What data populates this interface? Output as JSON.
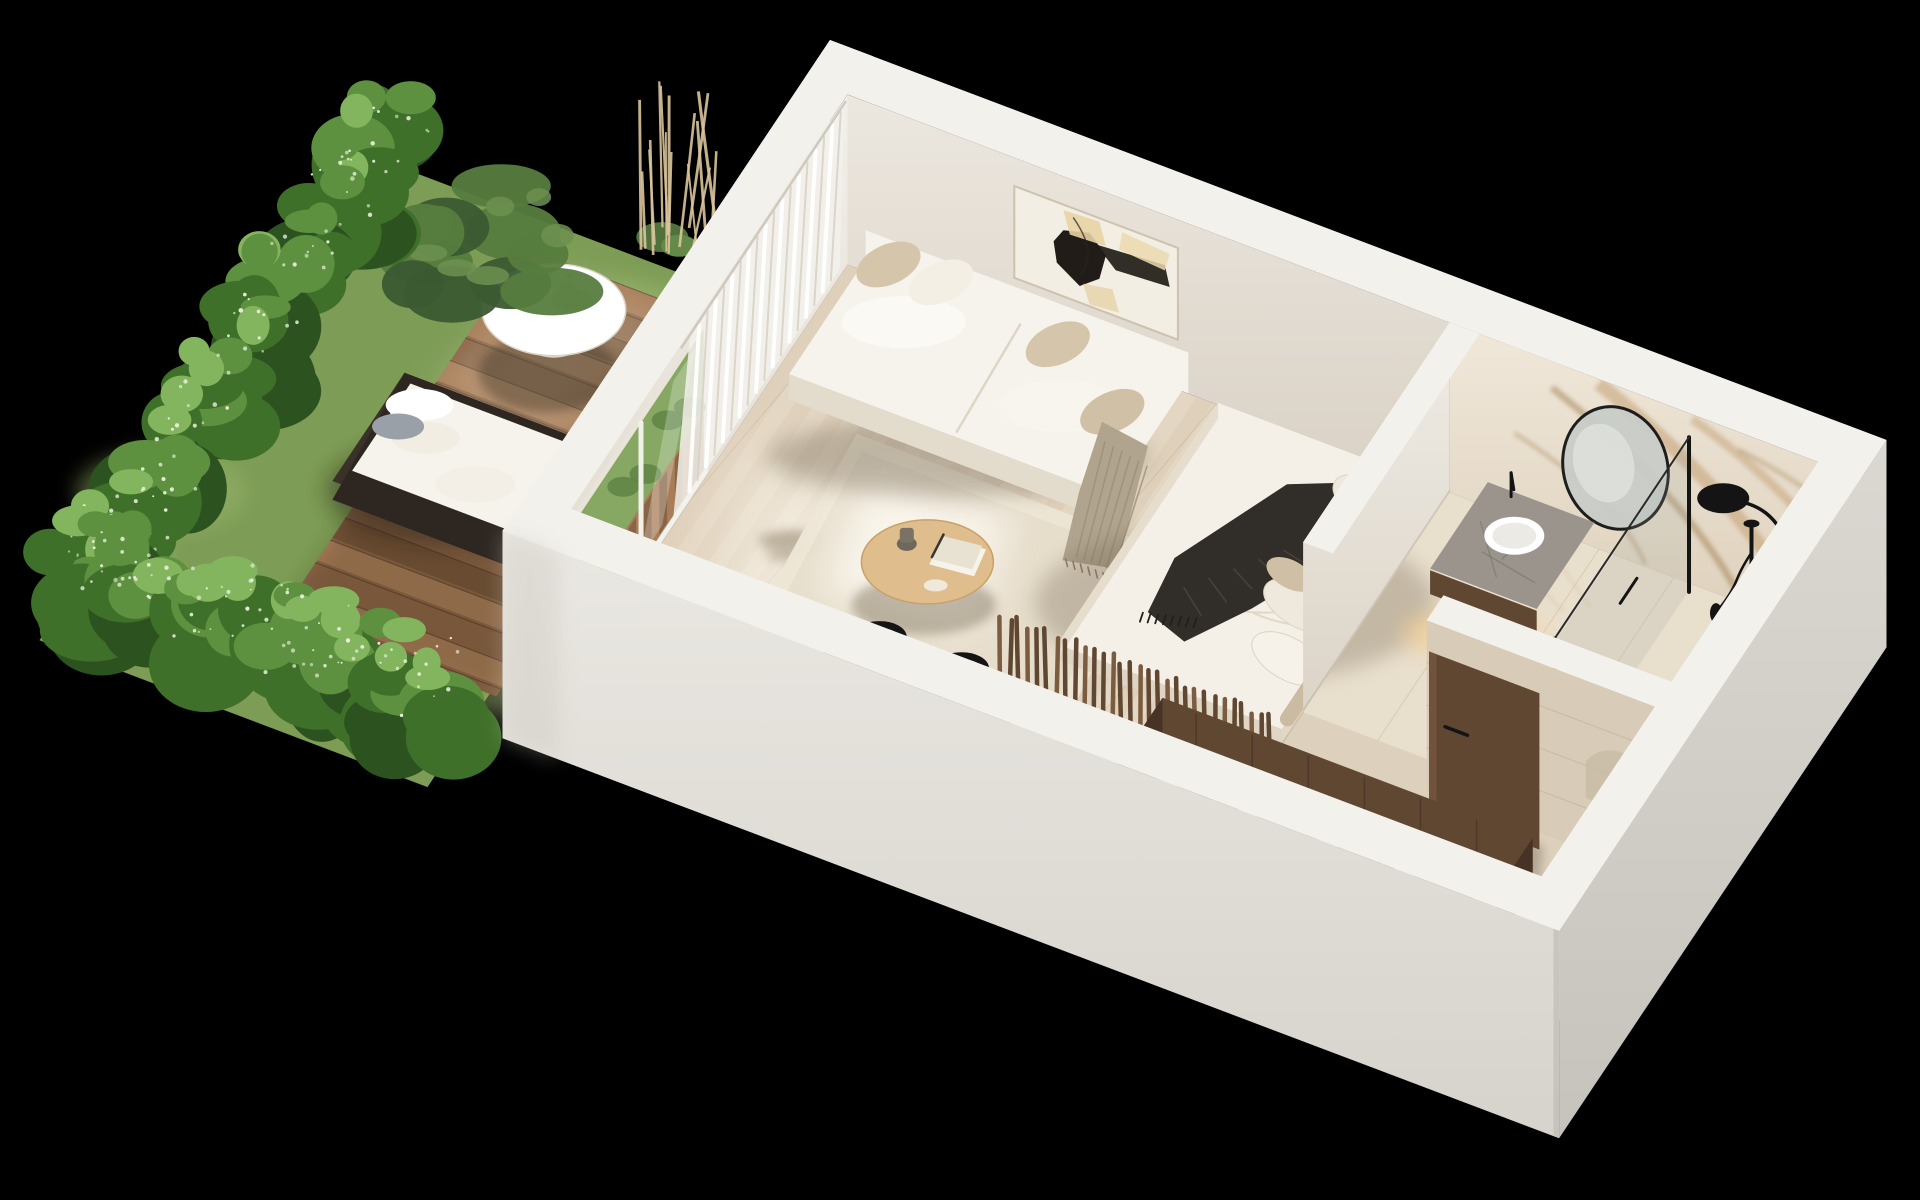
{
  "title": "Studio apartment with private garden terrace — 3D axonometric floor plan render",
  "palette": {
    "bg": "#000000",
    "wall_top": "#f3f1ec",
    "wall_top_shade": "#e9e6df",
    "wall_face": "#ece7df",
    "wall_face_low": "#d9d1c5",
    "wall_face_end": "#f1efe9",
    "facade_front": "#eae8e2",
    "facade_front_low": "#d6d3cc",
    "facade_side": "#dbd8d2",
    "facade_side_low": "#c6c3bc",
    "oak_floor": "#e3d6c2",
    "oak_floor_stripe": "#d3c2a8",
    "oak_floor_light": "#efe5d3",
    "marble_floor": "#e9dfcd",
    "marble_floor_vein": "#cdb795",
    "entry_floor": "#ddd1bd",
    "deck_a": "#8a6546",
    "deck_b": "#a87e59",
    "deck_c": "#75553a",
    "deck_gap": "#4a3422",
    "lawn": "#7d9c55",
    "lawn_light": "#99b56c",
    "hedge_dark": "#2c5220",
    "hedge_mid": "#3f7029",
    "hedge_light": "#5d9140",
    "hedge_tip": "#83b45e",
    "speckle": "#eef5e2",
    "pine_dark": "#3b5a31",
    "pine_light": "#567c3e",
    "pampas": "#d9c49a",
    "rug": "#ede5d5",
    "rug_shade": "#ddd2bd",
    "sofa": "#f6f3ec",
    "sofa_shade": "#e3dccd",
    "cushion_beige": "#d5c6ab",
    "throw_taupe": "#b1a48e",
    "oak_table": "#e0bd8d",
    "oak_table_shade": "#c9a06a",
    "walnut": "#5f4732",
    "walnut_dark": "#463326",
    "walnut_light": "#7b5c40",
    "counter": "#767069",
    "counter_dark": "#55504b",
    "black": "#141414",
    "steel": "#c2c0bb",
    "bed_white": "#f4f0e7",
    "bed_shade": "#ded5c4",
    "throw_dark": "#312d28",
    "throw_dark_hi": "#4c463d",
    "pillow_beige": "#cfc0a5",
    "headboard": "#cbbba2",
    "marble_wall": "#ece2d1",
    "marble_vein": "#c09a6b",
    "marble_vein2": "#a07f50",
    "mirror_glass": "#c9cdc8",
    "glass_green": "#86a862",
    "art_canvas": "#f2eee4",
    "art_black": "#211c17",
    "art_beige": "#e8d3a4",
    "door_beige": "#e7e1d4",
    "travertine": "#d8ccb8",
    "warm_light": "#f4cf92",
    "white": "#ffffff"
  },
  "scene": {
    "rooms": [
      {
        "name": "garden-terrace"
      },
      {
        "name": "living-kitchen"
      },
      {
        "name": "sleeping-area"
      },
      {
        "name": "bathroom"
      },
      {
        "name": "entry-wardrobe"
      }
    ],
    "objects": [
      "hedge",
      "lawn",
      "wooden-deck",
      "outdoor-daybed",
      "outdoor-coffee-table",
      "tea-set",
      "pine-shrub",
      "pampas-grass",
      "sheer-curtains",
      "sliding-glass-door",
      "abstract-wall-art",
      "sofa",
      "throw-pillows",
      "taupe-plaid",
      "area-rug",
      "round-coffee-table",
      "decor-books",
      "vase",
      "tv-screen",
      "dining-table",
      "dining-chairs",
      "place-settings",
      "kitchen-counter",
      "induction-cooktop",
      "pan",
      "kettle",
      "kitchen-sink",
      "rattan-jar",
      "bed",
      "dark-knit-throw",
      "bed-pillows",
      "wood-slat-partition",
      "vanity-counter",
      "vessel-sink",
      "round-mirror",
      "marble-feature-wall",
      "shower-glass",
      "black-shower-set",
      "wall-disc-lamp",
      "bathroom-door",
      "open-wardrobe",
      "hanging-clothes",
      "white-bench",
      "entry-door"
    ],
    "slat_count": 30,
    "curtain_fold_count": 18,
    "deck_plank_step": 27,
    "clothes_colors": [
      "#d8cbb4",
      "#2e2b27",
      "#eee8db",
      "#6f5d46",
      "#c8b595",
      "#3a362f",
      "#e2d9c6",
      "#514639",
      "#baa98e"
    ],
    "dining_chair_count": 2,
    "place_setting_count": 2,
    "bed_pillow_count": 4
  }
}
